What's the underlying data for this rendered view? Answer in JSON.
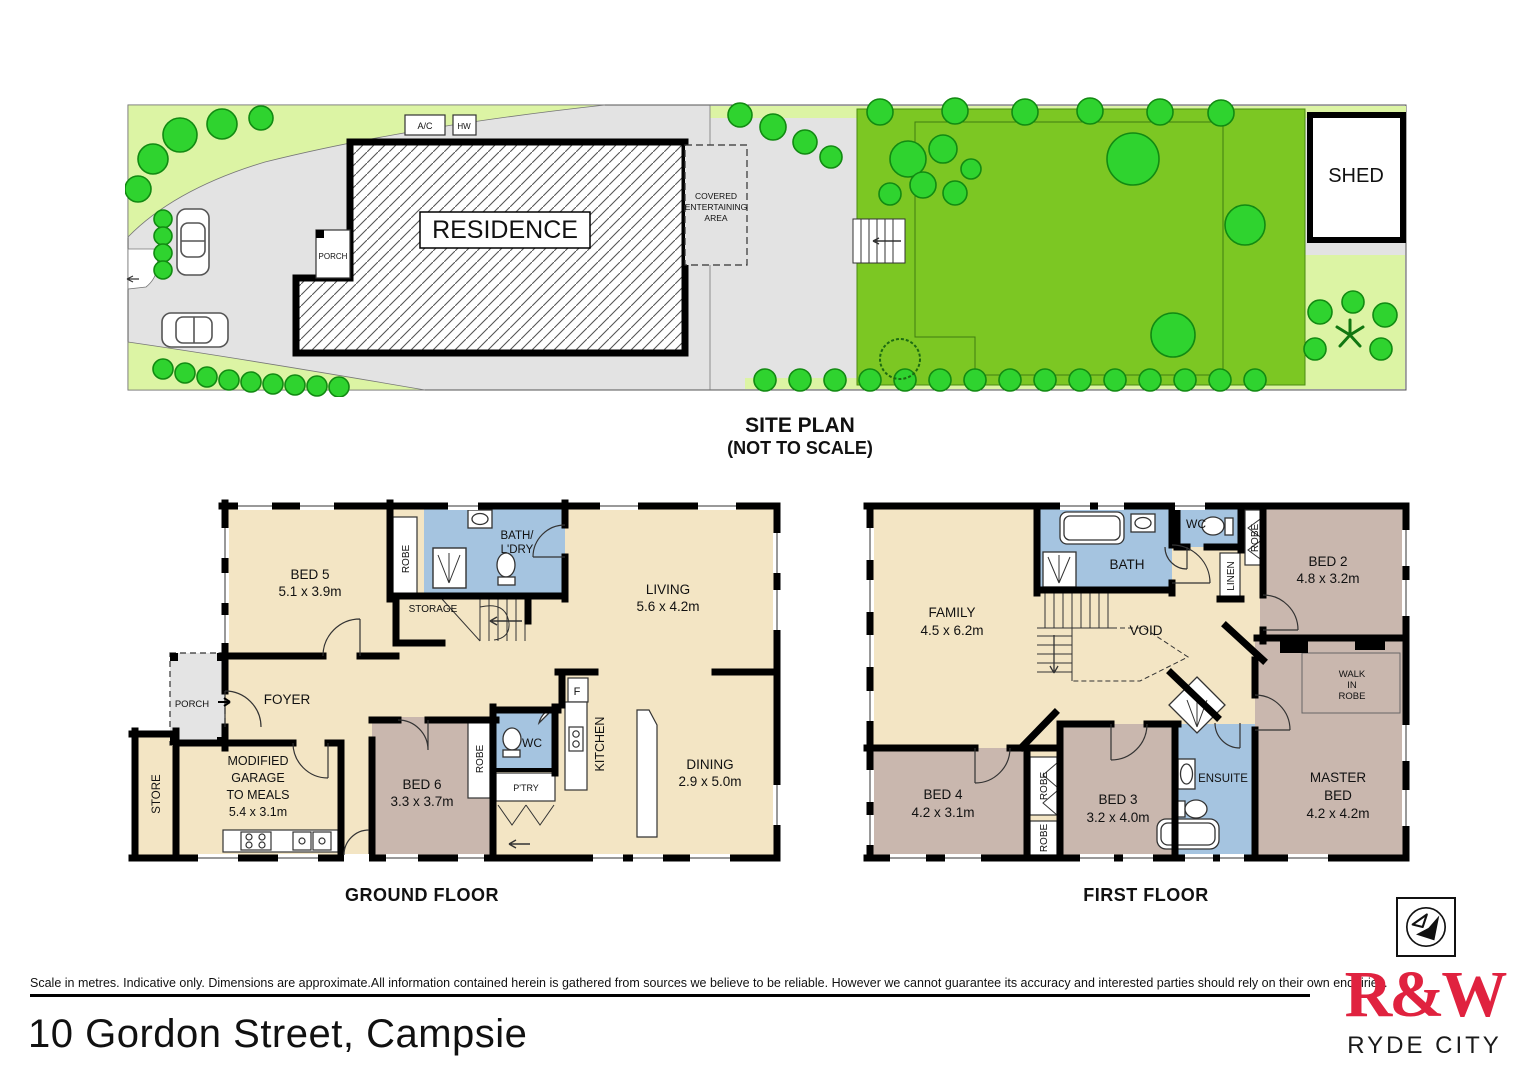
{
  "site": {
    "title": "SITE PLAN",
    "subtitle": "(NOT TO SCALE)",
    "residence": "RESIDENCE",
    "porch": "PORCH",
    "shed": "SHED",
    "ac": "A/C",
    "hw": "HW",
    "covered1": "COVERED",
    "covered2": "ENTERTAINING",
    "covered3": "AREA"
  },
  "gf": {
    "title": "GROUND FLOOR",
    "bed5_name": "BED 5",
    "bed5_dims": "5.1 x 3.9m",
    "robe": "ROBE",
    "bath1": "BATH/",
    "bath2": "L'DRY",
    "storage": "STORAGE",
    "living_name": "LIVING",
    "living_dims": "5.6 x 4.2m",
    "porch": "PORCH",
    "foyer": "FOYER",
    "store": "STORE",
    "garage1": "MODIFIED",
    "garage2": "GARAGE",
    "garage3": "TO MEALS",
    "garage4": "5.4 x 3.1m",
    "bed6_name": "BED 6",
    "bed6_dims": "3.3 x 3.7m",
    "bed6_robe": "ROBE",
    "wc": "WC",
    "ptry": "P'TRY",
    "kitchen_name": "KITCHEN",
    "kitchen_dims": "2.7 x 5.0m",
    "fridge": "F",
    "dining_name": "DINING",
    "dining_dims": "2.9 x 5.0m"
  },
  "ff": {
    "title": "FIRST FLOOR",
    "family_name": "FAMILY",
    "family_dims": "4.5 x 6.2m",
    "bath": "BATH",
    "wc": "WC",
    "linen": "LINEN",
    "robe_bed2": "ROBE",
    "bed2_name": "BED 2",
    "bed2_dims": "4.8 x 3.2m",
    "void": "VOID",
    "wir1": "WALK",
    "wir2": "IN",
    "wir3": "ROBE",
    "master1": "MASTER",
    "master2": "BED",
    "master_dims": "4.2 x 4.2m",
    "ensuite": "ENSUITE",
    "bed3_name": "BED 3",
    "bed3_dims": "3.2 x 4.0m",
    "bed4_name": "BED 4",
    "bed4_dims": "4.2 x 3.1m",
    "robe_a": "ROBE",
    "robe_b": "ROBE"
  },
  "footer": {
    "disclaimer": "Scale in metres. Indicative only. Dimensions are approximate.All information contained herein is gathered from sources we believe to be reliable. However we cannot guarantee its accuracy and interested parties should rely on their own enquiries.",
    "address": "10 Gordon Street, Campsie",
    "brand": "R&W",
    "brand_sub": "RYDE CITY"
  },
  "colors": {
    "floor_cream": "#f3e5c4",
    "bedroom_taupe": "#c9b7ae",
    "wet_area_blue": "#a5c4e0",
    "driveway_gray": "#e3e3e3",
    "lawn_green": "#7cc723",
    "garden_light_green": "#dcf4a4",
    "tree_green": "#2fd32f",
    "brand_red": "#e0223f"
  }
}
